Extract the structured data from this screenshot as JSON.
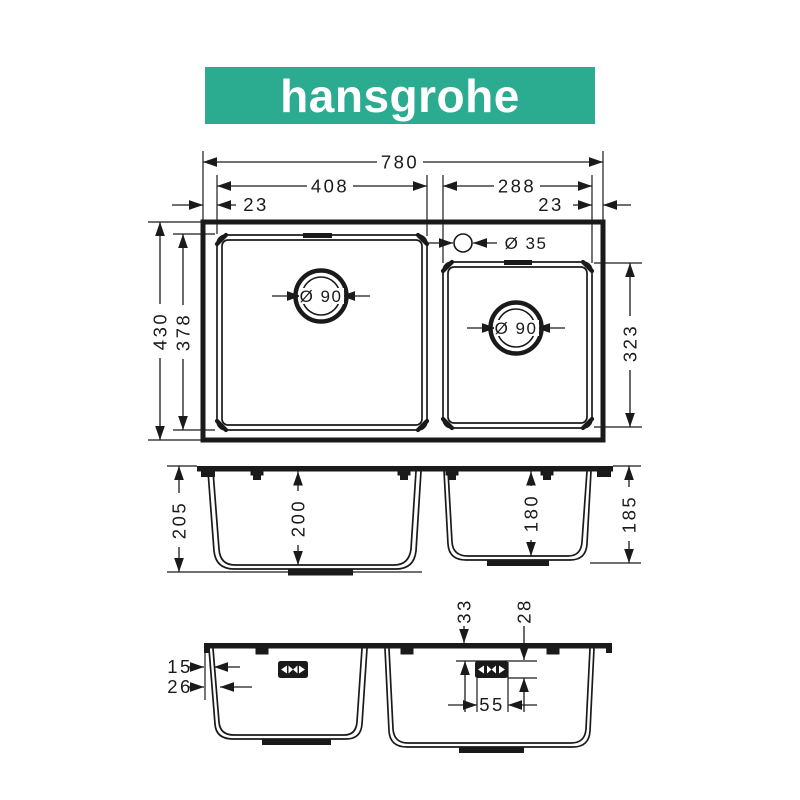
{
  "logo": {
    "text": "hansgrohe",
    "bg_color": "#2BAC90",
    "text_color": "#FFFFFF"
  },
  "colors": {
    "line": "#1A1A1A",
    "background": "#FFFFFF"
  },
  "top_view": {
    "overall_width": "780",
    "left_bowl_width": "408",
    "right_bowl_width": "288",
    "left_edge_gap": "23",
    "right_edge_gap": "23",
    "overall_depth": "430",
    "left_bowl_depth": "378",
    "right_bowl_depth": "323",
    "left_drain_diameter": "Ø 90",
    "right_drain_diameter": "Ø 90",
    "tap_hole_diameter": "Ø 35"
  },
  "front_view": {
    "left_outer_height": "205",
    "left_bowl_height": "200",
    "right_bowl_height": "180",
    "right_outer_height": "185"
  },
  "side_view": {
    "clip_offset": "33",
    "bracket_offset": "28",
    "rim_outer_offset": "15",
    "rim_inner_offset": "26",
    "bracket_width": "55"
  }
}
